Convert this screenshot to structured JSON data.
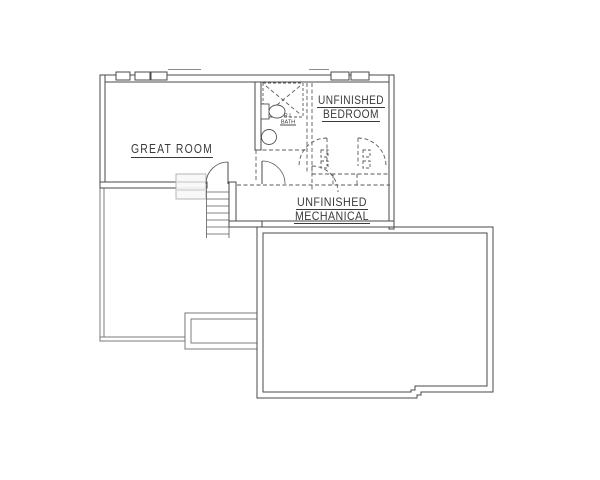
{
  "labels": {
    "great_room": "GREAT ROOM",
    "bedroom_line1": "UNFINISHED",
    "bedroom_line2": "BEDROOM",
    "mechanical_line1": "UNFINISHED",
    "mechanical_line2": "MECHANICAL",
    "bath_line1": "R.I.",
    "bath_line2": "BATH"
  },
  "colors": {
    "background": "#ffffff",
    "wall_line": "#4a4a4a",
    "thin_wall_line": "#6e6e6e",
    "dashed_future_wall": "#5a5a5a",
    "faint_stair_above": "#b5b5b5",
    "label_text": "#3a3a3a"
  }
}
